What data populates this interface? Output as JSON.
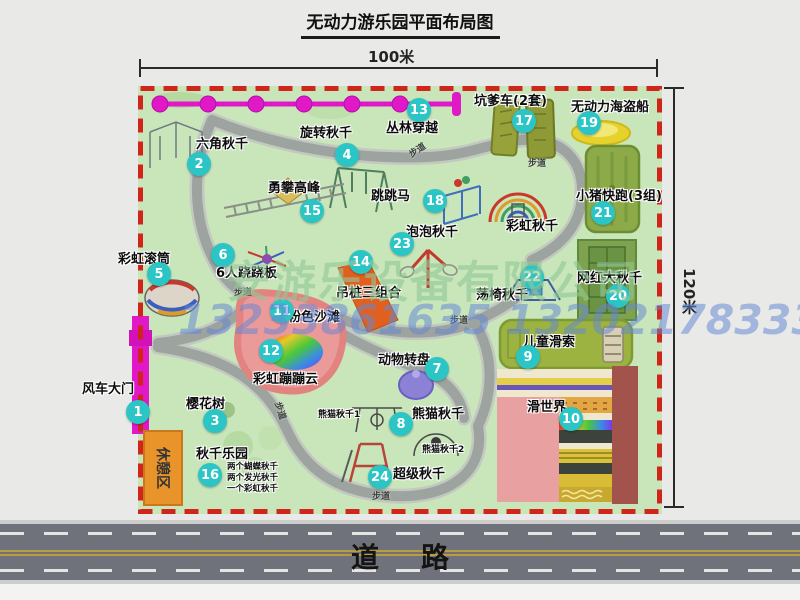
{
  "title": "无动力游乐园平面布局图",
  "dimensions": {
    "width": "100米",
    "height": "120米"
  },
  "road": {
    "label": "道路"
  },
  "watermark": {
    "company": "安游乐设备有限公司",
    "phones": "13233861635 13202178333"
  },
  "rest_area": "休憩区",
  "trail_label": "步道",
  "rainbow_swing_label": "彩虹秋千",
  "colors": {
    "park_green": "#c9e6ba",
    "border_red": "#d0251a",
    "marker_teal": "#2cc5c5",
    "gate_magenta": "#e018c8",
    "rest_orange": "#e8942a",
    "road_gray": "#6f727a",
    "path_gray": "#9da39e"
  },
  "attractions": [
    {
      "num": "1",
      "label": "风车大门"
    },
    {
      "num": "2",
      "label": "六角秋千"
    },
    {
      "num": "3",
      "label": "樱花树"
    },
    {
      "num": "4",
      "label": "旋转秋千"
    },
    {
      "num": "5",
      "label": "彩虹滚筒"
    },
    {
      "num": "6",
      "label": "6人跷跷板"
    },
    {
      "num": "7",
      "label": "动物转盘"
    },
    {
      "num": "8",
      "label": "熊猫秋千",
      "sub1": "熊猫秋千1",
      "sub2": "熊猫秋千2"
    },
    {
      "num": "9",
      "label": "儿童滑索"
    },
    {
      "num": "10",
      "label": "滑世界"
    },
    {
      "num": "11",
      "label": "粉色沙滩"
    },
    {
      "num": "12",
      "label": "彩虹蹦蹦云"
    },
    {
      "num": "13",
      "label": "丛林穿越"
    },
    {
      "num": "14",
      "label": "吊桩三组合"
    },
    {
      "num": "15",
      "label": "勇攀高峰"
    },
    {
      "num": "16",
      "label": "秋千乐园",
      "notes": [
        "两个蝴蝶秋千",
        "两个发光秋千",
        "一个彩虹秋千"
      ]
    },
    {
      "num": "17",
      "label": "坑爹车(2套)"
    },
    {
      "num": "18",
      "label": "跳跳马"
    },
    {
      "num": "19",
      "label": "无动力海盗船"
    },
    {
      "num": "20",
      "label": "网红大秋千"
    },
    {
      "num": "21",
      "label": "小猪快跑(3组)"
    },
    {
      "num": "22",
      "label": "荡椅秋千"
    },
    {
      "num": "23",
      "label": "泡泡秋千"
    },
    {
      "num": "24",
      "label": "超级秋千"
    }
  ]
}
